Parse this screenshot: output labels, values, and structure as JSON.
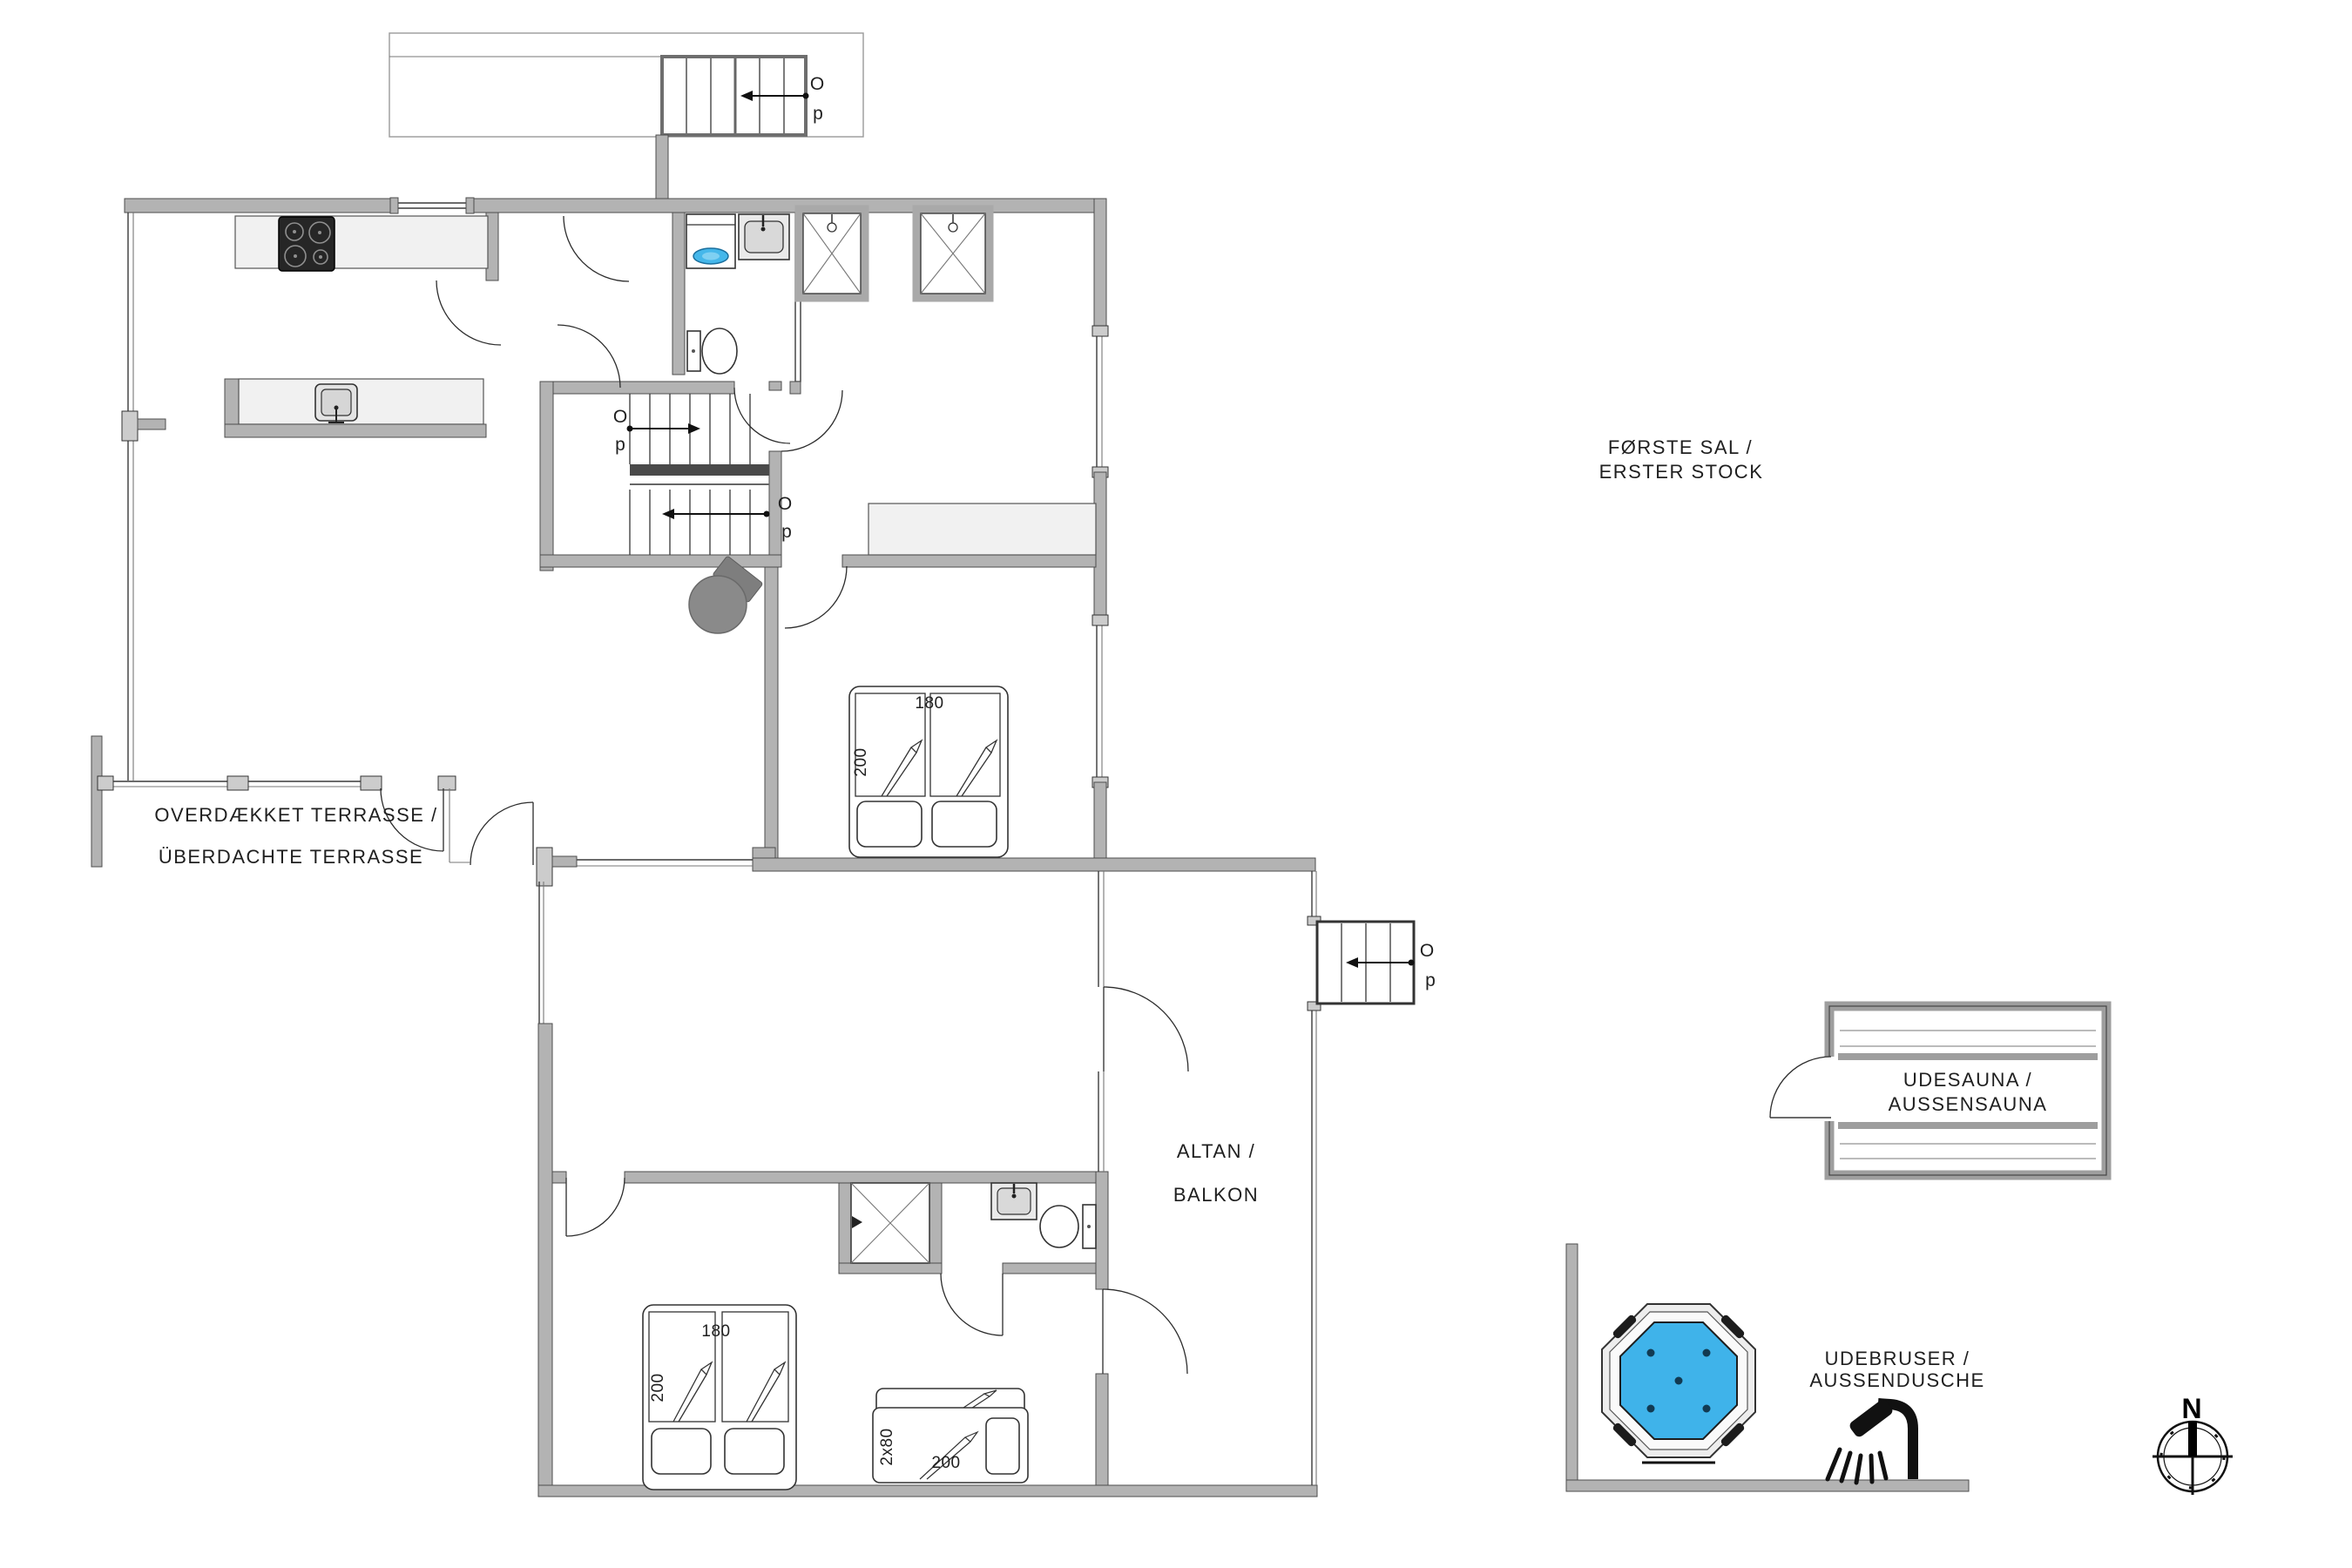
{
  "floor": {
    "label_line1": "FØRSTE SAL /",
    "label_line2": "ERSTER STOCK"
  },
  "areas": {
    "terrace_line1": "OVERDÆKKET TERRASSE /",
    "terrace_line2": "ÜBERDACHTE TERRASSE",
    "balcony_line1": "ALTAN /",
    "balcony_line2": "BALKON",
    "sauna_line1": "UDESAUNA /",
    "sauna_line2": "AUSSENSAUNA",
    "outdoor_shower_line1": "UDEBRUSER /",
    "outdoor_shower_line2": "AUSSENDUSCHE"
  },
  "stairs": {
    "o": "O",
    "p": "p"
  },
  "beds": {
    "double_width": "180",
    "double_length": "200",
    "bunk_width": "2x80",
    "bunk_length": "200"
  },
  "compass": {
    "north": "N"
  },
  "colors": {
    "wall": "#b3b3b3",
    "counter": "#f1f1f1",
    "water": "#3fb3ea",
    "stove": "#8a8a8a",
    "text": "#1f1f1f"
  }
}
